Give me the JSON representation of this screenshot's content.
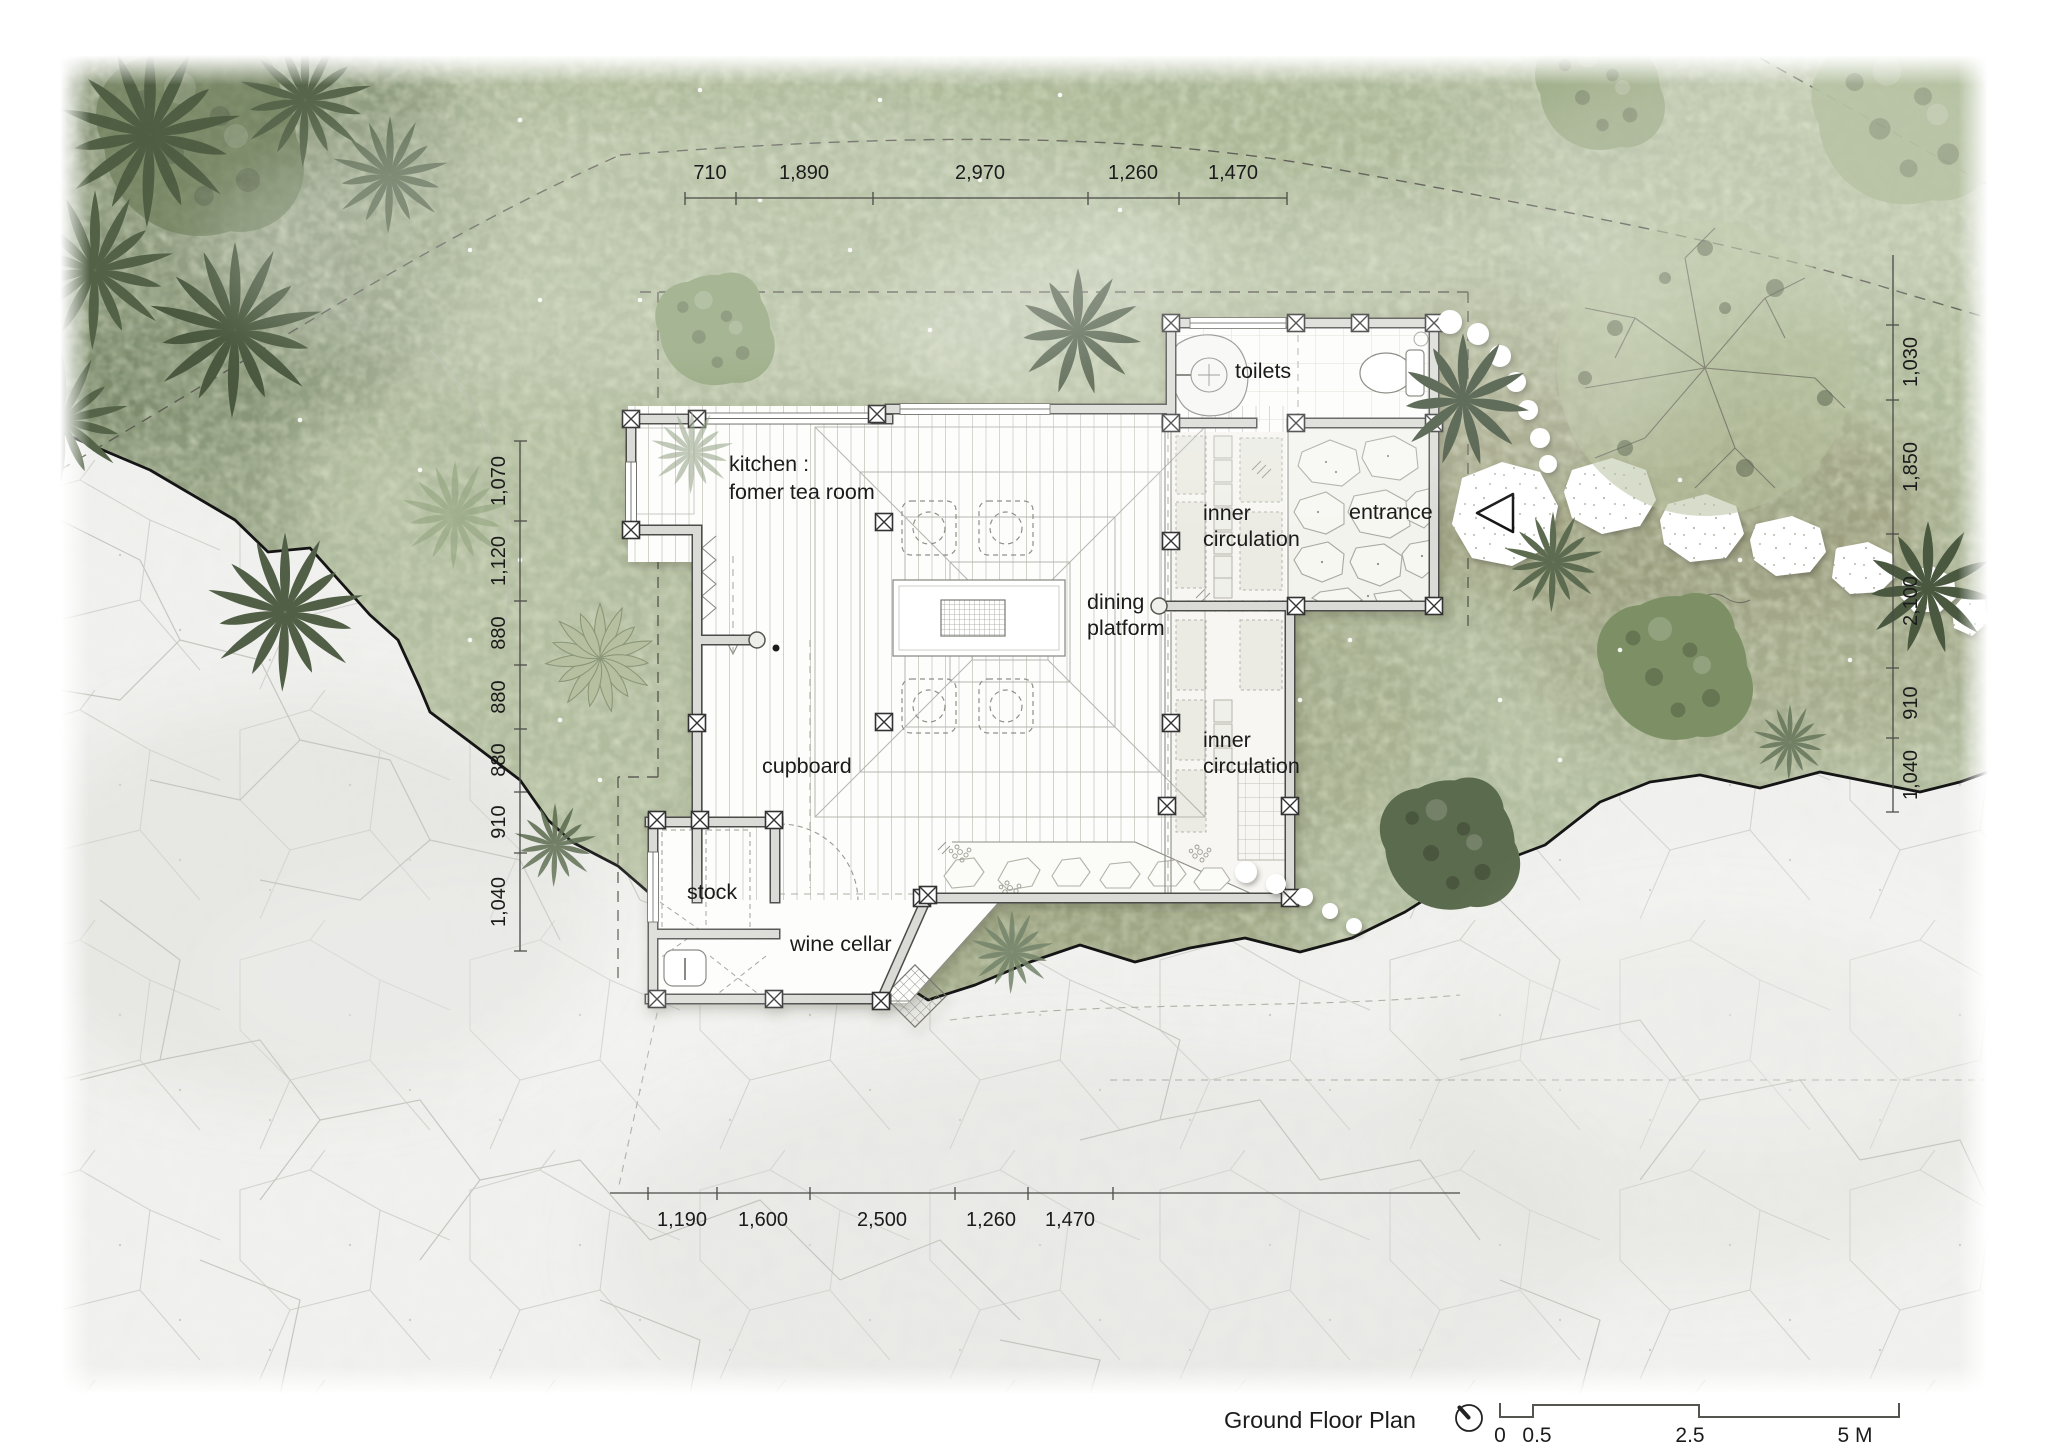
{
  "plan": {
    "rooms": {
      "toilets": "toilets",
      "kitchen_line1": "kitchen :",
      "kitchen_line2": "fomer tea room",
      "inner_circulation_line1": "inner",
      "inner_circulation_line2": "circulation",
      "entrance": "entrance",
      "dining_line1": "dining",
      "dining_line2": "platform",
      "cupboard": "cupboard",
      "stock": "stock",
      "wine_cellar": "wine cellar"
    },
    "dimensions": {
      "top": [
        "710",
        "1,890",
        "2,970",
        "1,260",
        "1,470"
      ],
      "bottom": [
        "1,190",
        "1,600",
        "2,500",
        "1,260",
        "1,470"
      ],
      "left": [
        "1,070",
        "1,120",
        "880",
        "880",
        "880",
        "910",
        "1,040"
      ],
      "right": [
        "1,030",
        "1,850",
        "2,100",
        "910",
        "1,040"
      ]
    },
    "footer": {
      "title": "Ground Floor Plan",
      "scale": [
        "0",
        "0.5",
        "2.5",
        "5 M"
      ]
    },
    "colors": {
      "vegetation": "#b7c1a4",
      "dark_foliage": "#4d5c42",
      "rock": "#f1f1ef",
      "wall_fill": "#dadad6",
      "wall_outline": "#4b4b48",
      "floor": "#fdfdfc",
      "text": "#1b1b1b"
    }
  }
}
